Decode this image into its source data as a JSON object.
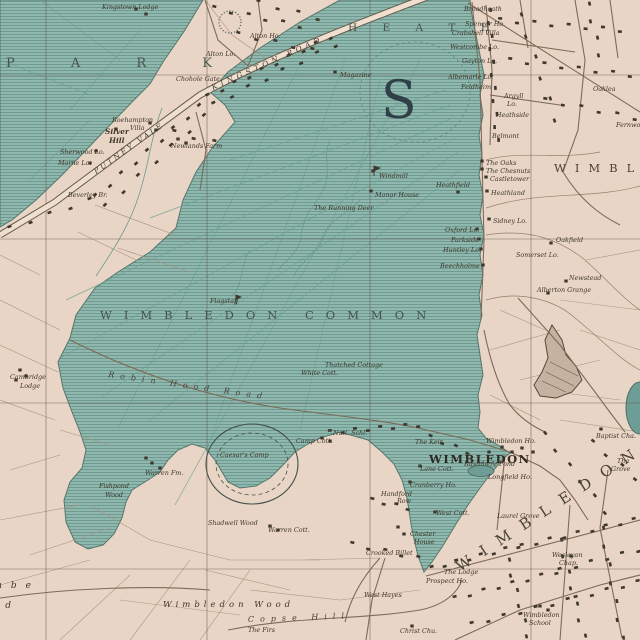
{
  "map": {
    "colors": {
      "land": "#e9d5c5",
      "common_green": "#8fb9ae",
      "pond_green": "#6d9d95",
      "road_fill": "#eedfd0",
      "road_edge": "#6a5c4b",
      "building": "#3f382e",
      "ink": "#3e372c",
      "area_text": "#46524b"
    },
    "area_labels": {
      "park": "P A R K",
      "heath": "H E A T H",
      "wimbledon_common": "WIMBLEDON COMMON",
      "wimbledon_park_edge": "WIMBLEDON",
      "wimbledon_diag": "WIMBLEDON",
      "big_letter": "S",
      "wimbledon_town": "WIMBLEDON",
      "wimbledon_wood": "Wimbledon Wood",
      "coombe_partial": "Coombe",
      "coombe_wood_partial": "Wood"
    },
    "road_labels": {
      "kingston_road": "KINGSTON ROAD",
      "putney_vale": "PUTNEY VALE",
      "robin_hood_road": "Robin Hood Road",
      "copse_hill": "Copse Hill"
    },
    "place_labels": {
      "kingstown_lodge": "Kingstown Lodge",
      "alton_ho": "Alton Ho.",
      "alton_lo": "Alton Lo.",
      "chohole_gate": "Chohole Gate",
      "magazine": "Magazine",
      "sherwood_lo": "Sherwood Lo.",
      "marne_lo": "Marne Lo.",
      "newlands_farm": "Newlands Farm",
      "beverley_br": "Beverley Br.",
      "broadheath": "Broadheath",
      "spencer_ho": "Spencer Ho.",
      "crabshell_villa": "Crabshell Villa",
      "westcombe_lo": "Westcombe Lo.",
      "gayton_lo": "Gayton Lo.",
      "albemarle_lo": "Albemarle Lo.",
      "feldheim": "Feldheim",
      "heathside": "Heathside",
      "belmont": "Belmont",
      "oaklea": "Oaklea",
      "fernwood": "Fernwood",
      "the_oaks": "The Oaks",
      "the_chesnuts": "The Chesnuts",
      "castletower": "Castletower",
      "heathfield": "Heathfield",
      "heathland": "Heathland",
      "windmill": "Windmill",
      "manor_house": "Manor House",
      "running_deer": "The Running Deer",
      "sidney_lo": "Sidney Lo.",
      "oxford_lo": "Oxford Lo.",
      "parkside_ho": "Parkside",
      "huntley_lo": "Huntley Lo.",
      "beechholme": "Beechholme",
      "oakfield": "Oakfield",
      "somerset_lo": "Somerset Lo.",
      "newstead": "Newstead",
      "alberton_grange": "Alberton Grange",
      "flagstaff": "Flagstaff",
      "thatched_cottage": "Thatched Cottage",
      "white_cott": "White Cott.",
      "warren_fm": "Warren Fm.",
      "shadwell_wood": "Shadwell Wood",
      "warren_cott": "Warren Cott.",
      "caesars_camp": "Caesar's Camp",
      "camp_cott": "Camp Cott.",
      "natl_schl": "Natl. Schl.",
      "the_keir": "The Keir.",
      "wimbledon_ho": "Wimbledon Ho.",
      "lane_cott": "Lane Cott.",
      "rushmere_pond": "Rushmere Pond",
      "longfield_ho": "Longfield Ho.",
      "cranberry_ho": "Cranberry Ho.",
      "west_cott": "West Cott.",
      "crooked_billet": "Crooked Billet",
      "laurel_grove": "Laurel Grove",
      "west_hayes": "West Hayes",
      "the_firs": "The Firs",
      "the_lodge": "The Lodge",
      "prospect_ho": "Prospect Ho.",
      "christ_chu": "Christ Chu.",
      "baptist_cha": "Baptist Cha."
    },
    "multiline_labels": {
      "roehampton_villa": {
        "l1": "Roehampton",
        "l2": "Villa"
      },
      "silver_hill": {
        "l1": "Silver",
        "l2": "Hill"
      },
      "argyll_lo": {
        "l1": "Argyll",
        "l2": "Lo."
      },
      "cambridge_lodge": {
        "l1": "Cambridge",
        "l2": "Lodge"
      },
      "fishpond_wood": {
        "l1": "Fishpond",
        "l2": "Wood"
      },
      "handford_row": {
        "l1": "Handford",
        "l2": "Row"
      },
      "chester_house": {
        "l1": "Chester",
        "l2": "House"
      },
      "wesleyan_chap": {
        "l1": "Wesleyan",
        "l2": "Chap."
      },
      "wimbledon_school": {
        "l1": "Wimbledon",
        "l2": "School"
      },
      "the_grove": {
        "l1": "The",
        "l2": "Grove"
      }
    }
  }
}
